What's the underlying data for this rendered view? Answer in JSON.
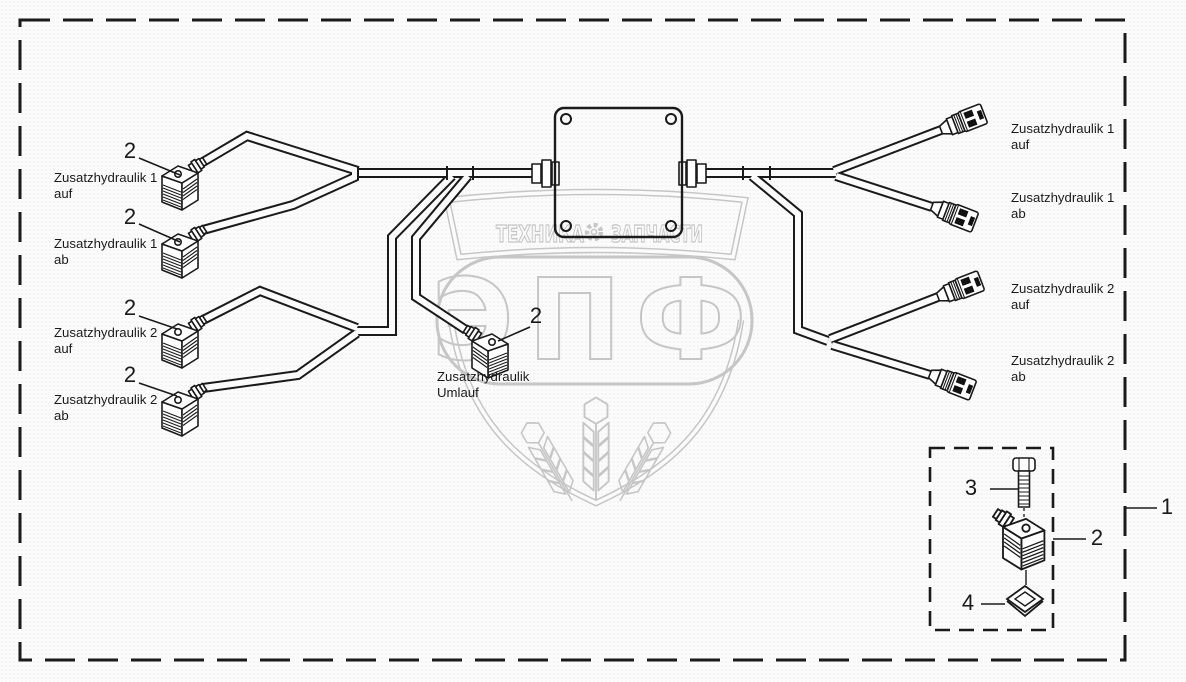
{
  "colors": {
    "line": "#1a1a1a",
    "watermark": "#c6c6c6",
    "background": "#fbfbfb",
    "connector_dark": "#111111"
  },
  "frame": {
    "callout_assembly": "1"
  },
  "connectors_left": [
    {
      "callout": "2",
      "label_line1": "Zusatzhydraulik 1",
      "label_line2": "auf"
    },
    {
      "callout": "2",
      "label_line1": "Zusatzhydraulik 1",
      "label_line2": "ab"
    },
    {
      "callout": "2",
      "label_line1": "Zusatzhydraulik 2",
      "label_line2": "auf"
    },
    {
      "callout": "2",
      "label_line1": "Zusatzhydraulik 2",
      "label_line2": "ab"
    }
  ],
  "connector_center": {
    "callout": "2",
    "label_line1": "Zusatzhydraulik",
    "label_line2": "Umlauf"
  },
  "connectors_right": [
    {
      "label_line1": "Zusatzhydraulik 1",
      "label_line2": "auf"
    },
    {
      "label_line1": "Zusatzhydraulik 1",
      "label_line2": "ab"
    },
    {
      "label_line1": "Zusatzhydraulik 2",
      "label_line2": "auf"
    },
    {
      "label_line1": "Zusatzhydraulik 2",
      "label_line2": "ab"
    }
  ],
  "detail_box": {
    "callout_bolt": "3",
    "callout_connector": "2",
    "callout_seal": "4"
  },
  "watermark": {
    "brand": "ЭПФ",
    "tagline_left": "ТЕХНИКА",
    "tagline_right": "ЗАПЧАСТИ"
  }
}
